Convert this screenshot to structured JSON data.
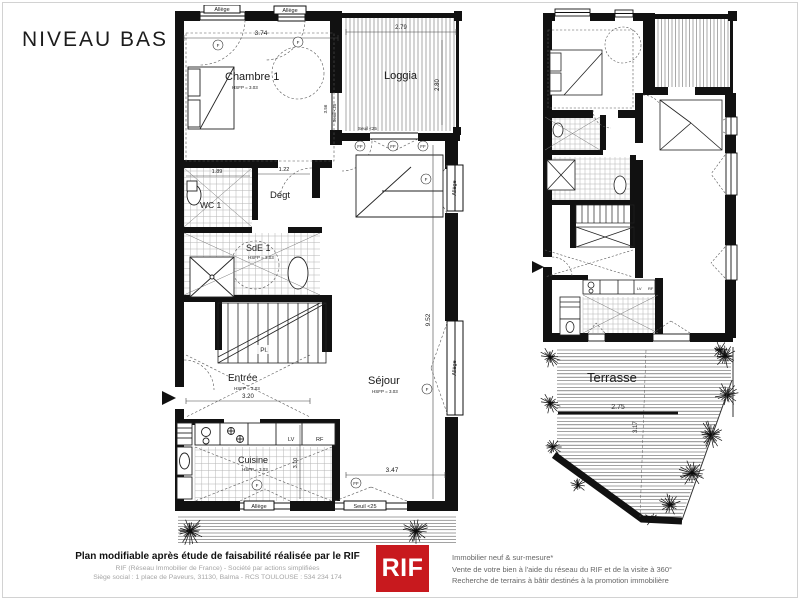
{
  "title": "NIVEAU BAS",
  "colors": {
    "brand_red": "#c8191e",
    "ink": "#111111"
  },
  "shared": {
    "allege": "Allège",
    "seuil": "Seuil <25",
    "hsfp": "HSFP = 3.03",
    "f": "F",
    "ff": "FF",
    "lv": "LV",
    "rf": "RF"
  },
  "left_plan": {
    "rooms": {
      "chambre": "Chambre 1",
      "loggia": "Loggia",
      "wc": "WC 1",
      "degt": "Dégt",
      "sde": "SdE 1",
      "placard": "Pl.",
      "entree": "Entrée",
      "sejour": "Séjour",
      "cuisine": "Cuisine"
    },
    "dims": {
      "chambre_width": "3.74",
      "loggia_width": "2.79",
      "loggia_depth": "2.80",
      "wc_width": "1.89",
      "degt_width": "1.22",
      "chambre_door": "3.56",
      "entree_width": "3.20",
      "cuisine_depth": "3.10",
      "sejour_width": "3.47",
      "sejour_depth": "9.52"
    }
  },
  "right_plan": {
    "rooms": {
      "terrasse": "Terrasse"
    },
    "dims": {
      "terrasse_width": "2.75",
      "terrasse_depth": "3.17"
    }
  },
  "footer": {
    "headline": "Plan modifiable après étude de faisabilité réalisée par le RIF",
    "company_line": "RIF (Réseau Immobilier de France) - Société par actions simplifiées",
    "address_line": "Siège social : 1 place de Paveurs, 31130, Balma - RCS TOULOUSE : 534 234 174",
    "logo_text": "RIF",
    "services": [
      "Immobilier neuf & sur-mesure*",
      "Vente de votre bien à l'aide du réseau du RIF et de la visite à 360°",
      "Recherche de terrains à bâtir destinés à la promotion immobilière"
    ]
  }
}
